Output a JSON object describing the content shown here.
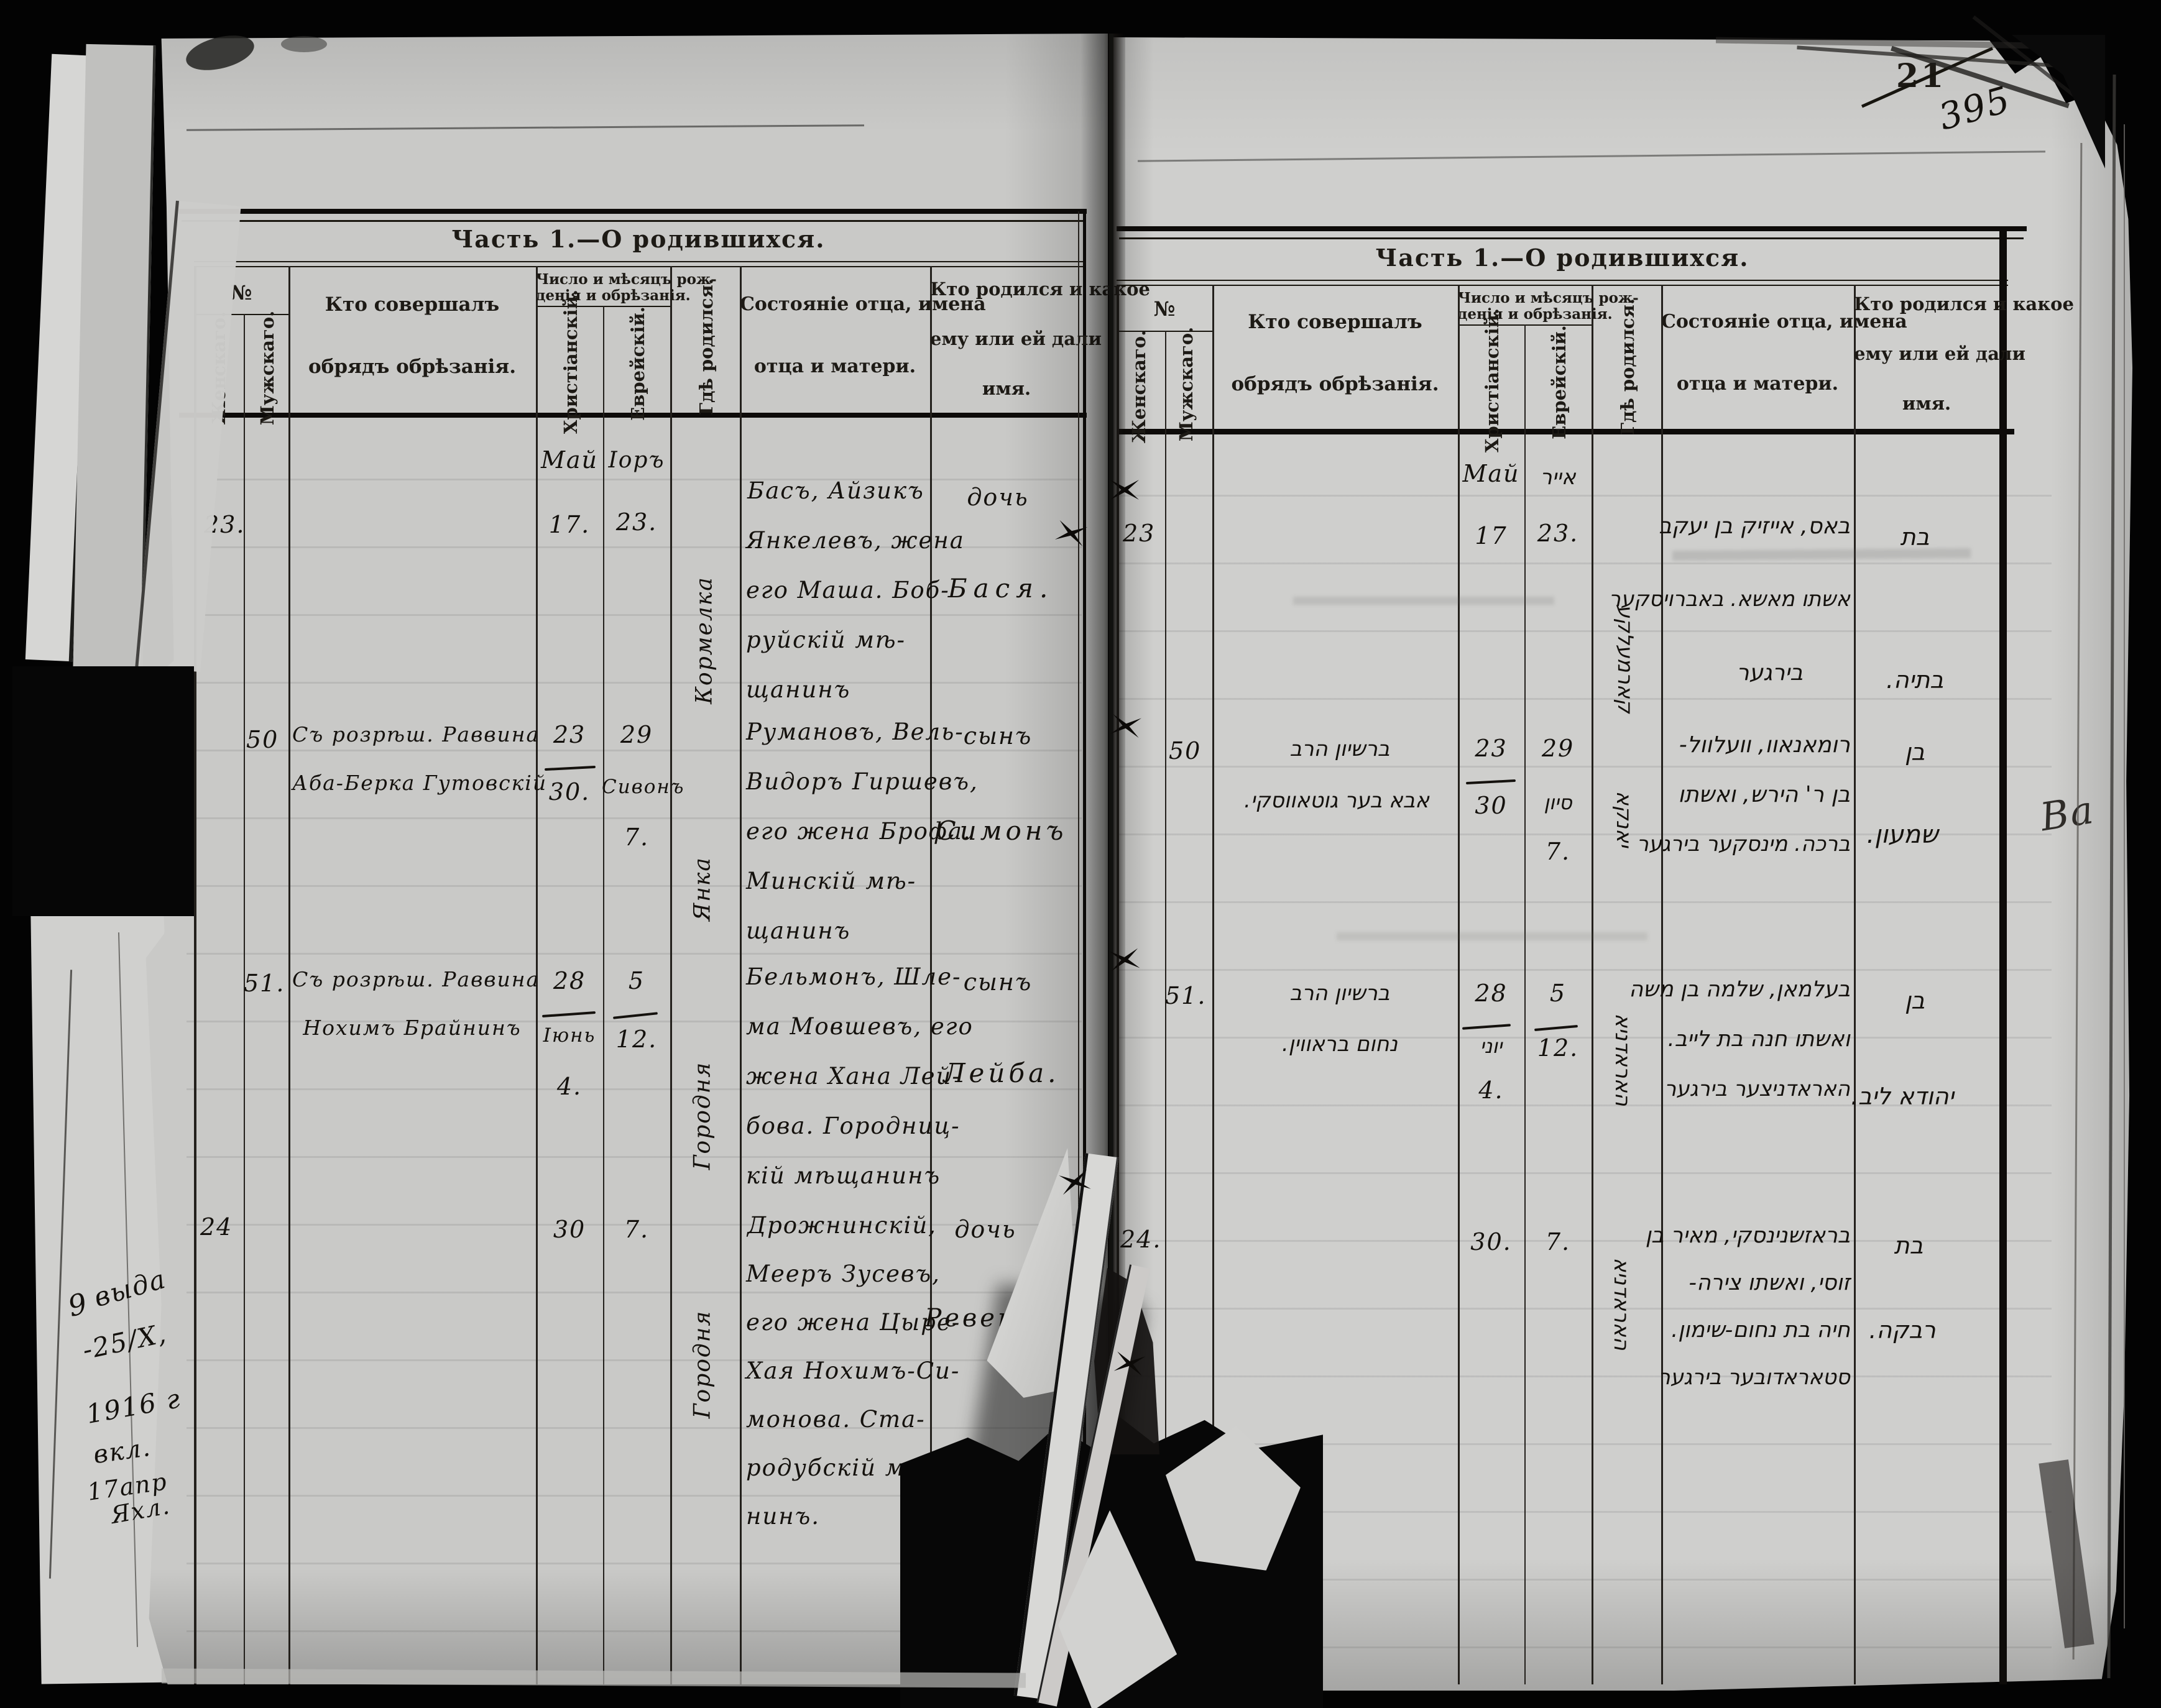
{
  "document": {
    "title_left": "Часть 1.—О родившихся.",
    "title_right": "Часть 1.—О родившихся.",
    "page_number_printed": "21",
    "page_number_written": "395"
  },
  "columns": {
    "no": "№",
    "female": "Женскаго.",
    "male": "Мужскаго.",
    "who_1": "Кто совершалъ",
    "who_2": "обрядъ обрѣзанія.",
    "dates_1": "Число и мѣсяцъ рож-",
    "dates_2": "денія и обрѣзанія.",
    "christian": "Христіанскій.",
    "jewish": "Еврейскій.",
    "where": "Гдѣ родился.",
    "father_1": "Состояніе отца, имена",
    "father_2": "отца и матери.",
    "name_1": "Кто родился и какое",
    "name_2": "ему или ей дали",
    "name_3": "имя."
  },
  "left": {
    "month_christian": "Май",
    "month_jewish": "Іоръ",
    "rows": [
      {
        "no": "23.",
        "christian_1": "17.",
        "jewish_1": "23.",
        "where": "Кормелка",
        "father": [
          "Басъ, Айзикъ",
          "Янкелевъ, жена",
          "его Маша. Боб-",
          "руйскій мѣ-",
          "щанинъ"
        ],
        "child": "дочь",
        "name": "Бася."
      },
      {
        "no": "50",
        "who_1": "Съ розрѣш. Раввина",
        "who_2": "Аба-Берка Гутовскій",
        "christian_1": "23",
        "christian_2": "30.",
        "jewish_1": "29",
        "jewish_2": "Сивонъ",
        "jewish_3": "7.",
        "where": "Янка",
        "father": [
          "Румановъ, Вель-",
          "Видоръ Гиршевъ,",
          "его жена Брофа.",
          "Минскій мѣ-",
          "щанинъ"
        ],
        "child": "сынъ",
        "name": "Симонъ"
      },
      {
        "no": "51.",
        "who_1": "Съ розрѣш. Раввина",
        "who_2": "Нохимъ Брайнинъ",
        "christian_1": "28",
        "christian_2": "Іюнь",
        "christian_3": "4.",
        "jewish_1": "5",
        "jewish_2": "12.",
        "where": "Городня",
        "father": [
          "Бельмонъ, Шле-",
          "ма Мовшевъ, его",
          "жена Хана Лей-",
          "бова. Городниц-",
          "кій мѣщанинъ"
        ],
        "child": "сынъ",
        "name": "Лейба."
      },
      {
        "no": "24",
        "christian_1": "30",
        "jewish_1": "7.",
        "where": "Городня",
        "father": [
          "Дрожнинскій,",
          "Мееръ Зусевъ,",
          "его жена Цыре-",
          "Хая Нохимъ-Си-",
          "монова. Ста-",
          "родубскій мѣща-",
          "нинъ."
        ],
        "child": "дочь",
        "name": "Ревека"
      }
    ]
  },
  "right": {
    "month_christian": "Май",
    "month_jewish": "אייר",
    "rows": [
      {
        "no": "23",
        "christian_1": "17",
        "jewish_1": "23.",
        "where": "קארמעלקע",
        "father": [
          "באס, אייזיק בן יעקב",
          "אשתו מאשא. באברויסקער",
          "בירגער"
        ],
        "child": "בת",
        "name": "בתיה."
      },
      {
        "no": "50",
        "who_1": "ברשיון הרב",
        "who_2": "אבא בער גוטאווסקי.",
        "christian_1": "23",
        "christian_2": "30",
        "jewish_1": "29",
        "jewish_2": "סיון",
        "jewish_3": "7.",
        "where": "יאנקא",
        "father": [
          "רומאנאוו, וועלוול-",
          "בן ר' הירש, ואשתו",
          "ברכה. מינסקער בירגער"
        ],
        "child": "בן",
        "name": "שמעון."
      },
      {
        "no": "51.",
        "who_1": "ברשיון הרב",
        "who_2": "נחום בראווין.",
        "christian_1": "28",
        "christian_2": "יוני",
        "christian_3": "4.",
        "jewish_1": "5",
        "jewish_2": "12.",
        "where": "האראדניא",
        "father": [
          "בעלמאן, שלמה בן משה",
          "ואשתו חנה בת לייב.",
          "האראדניצער בירגער"
        ],
        "child": "בן",
        "name": "יהודא ליב."
      },
      {
        "no": "24.",
        "christian_1": "30.",
        "jewish_1": "7.",
        "where": "האראדניא",
        "father": [
          "בראזשנינסקי, מאיר בן",
          "זוסי, ואשתו צירה-",
          "חיה בת נחום-שימון.",
          "סטאראדובער בירגער"
        ],
        "child": "בת",
        "name": "רבקה."
      }
    ]
  },
  "margin": {
    "note_prefix": "9",
    "note_lines": [
      "выда",
      "-25/X,",
      "1916 г",
      "вкл.",
      "17апр",
      "Яхл."
    ],
    "side_scribble": "Ba"
  }
}
